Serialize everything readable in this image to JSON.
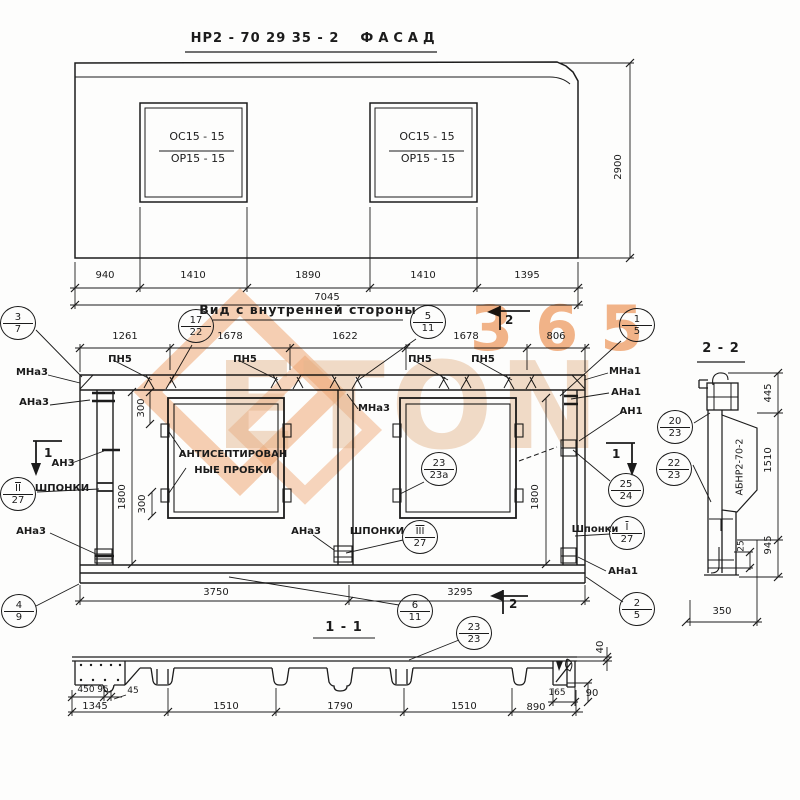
{
  "drawing": {
    "facade": {
      "title_code": "НР2 - 70 29 35 - 2",
      "title_word": "ФАСАД",
      "opening_mark_top": "ОС15 - 15",
      "opening_mark_bottom": "ОР15 - 15",
      "dims_bottom": [
        "940",
        "1410",
        "1890",
        "1410",
        "1395"
      ],
      "dim_total": "7045",
      "dim_height": "2900"
    },
    "inner_view": {
      "title": "Вид с внутренней стороны",
      "dims_top": [
        "1261",
        "1678",
        "1622",
        "1678",
        "806"
      ],
      "dims_bottom": [
        "3750",
        "3295"
      ],
      "dim_height_left": "1800",
      "dim_height_right": "1800",
      "dim_plug_top": "300",
      "dim_plug_bottom": "300",
      "labels": {
        "pn5": "ПН5",
        "mna3": "МНа3",
        "ana3": "АНа3",
        "an3": "АН3",
        "mna1": "МНа1",
        "ana1": "АНа1",
        "an1": "АН1",
        "shponki": "ШПОНКИ",
        "shponki_right": "Шпонки",
        "plugs_line1": "АНТИСЕПТИРОВАН",
        "plugs_line2": "НЫЕ ПРОБКИ"
      },
      "section_marks": {
        "one": "1",
        "two": "2"
      }
    },
    "section_1_1": {
      "title": "1 - 1",
      "dims_bottom": [
        "1345",
        "1510",
        "1790",
        "1510",
        "890"
      ],
      "dims_sub": [
        "450",
        "95",
        "45"
      ],
      "dim_40": "40",
      "dim_165": "165",
      "dim_90": "90"
    },
    "section_2_2": {
      "title": "2 - 2",
      "stamp": "АБНР2-70-2",
      "dims_right": [
        "445",
        "1510",
        "945"
      ],
      "dim_offset": "25",
      "dim_width": "350"
    },
    "callouts": {
      "c3_7": {
        "top": "3",
        "bot": "7"
      },
      "c17_22": {
        "top": "17",
        "bot": "22"
      },
      "c5_11": {
        "top": "5",
        "bot": "11"
      },
      "c1_5": {
        "top": "1",
        "bot": "5"
      },
      "c23_23a": {
        "top": "23",
        "bot": "23а"
      },
      "c25_24": {
        "top": "25",
        "bot": "24"
      },
      "cI_27": {
        "top": "I",
        "bot": "27"
      },
      "cIII_27": {
        "top": "III",
        "bot": "27"
      },
      "cII_27": {
        "top": "II",
        "bot": "27"
      },
      "c4_9": {
        "top": "4",
        "bot": "9"
      },
      "c6_11": {
        "top": "6",
        "bot": "11"
      },
      "c23_23": {
        "top": "23",
        "bot": "23"
      },
      "c2_5": {
        "top": "2",
        "bot": "5"
      },
      "c20_23": {
        "top": "20",
        "bot": "23"
      },
      "c22_23": {
        "top": "22",
        "bot": "23"
      }
    }
  },
  "watermark": {
    "brand": "ETON",
    "number": "365",
    "accent_color": "#ef9d63",
    "text_color": "#e3b68e"
  }
}
